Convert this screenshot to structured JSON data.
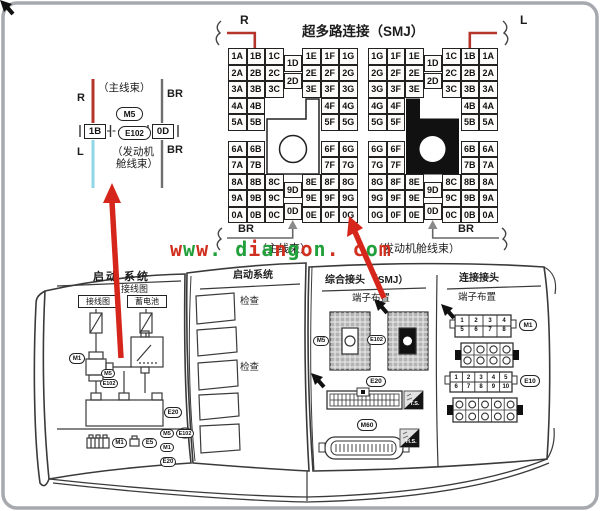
{
  "title": "超多路连接（SMJ）",
  "watermark": {
    "text": "www. diangon. com",
    "color_a": "#d03020",
    "color_b": "#22a03c"
  },
  "smj": {
    "r_label": "R",
    "l_label": "L",
    "br_left": "BR",
    "br_right": "BR",
    "main_harness_label": "（主线束）",
    "engine_harness_label": "（发动机舱线束）",
    "left_grid": {
      "rows": [
        [
          "1A",
          "1B",
          "1C",
          "1D",
          "1E",
          "1F",
          "1G"
        ],
        [
          "2A",
          "2B",
          "2C",
          "2D",
          "2E",
          "2F",
          "2G"
        ],
        [
          "3A",
          "3B",
          "3C",
          null,
          "3E",
          "3F",
          "3G"
        ],
        [
          "4A",
          "4B",
          null,
          null,
          null,
          "4F",
          "4G"
        ],
        [
          "5A",
          "5B",
          null,
          null,
          null,
          "5F",
          "5G"
        ],
        [
          "6A",
          "6B",
          null,
          null,
          null,
          "6F",
          "6G"
        ],
        [
          "7A",
          "7B",
          null,
          null,
          null,
          "7F",
          "7G"
        ],
        [
          "8A",
          "8B",
          "8C",
          "9D",
          "8E",
          "8F",
          "8G"
        ],
        [
          "9A",
          "9B",
          "9C",
          null,
          "9E",
          "9F",
          "9G"
        ],
        [
          "0A",
          "0B",
          "0C",
          "0D",
          "0E",
          "0F",
          "0G"
        ]
      ]
    },
    "right_grid": {
      "rows": [
        [
          "1G",
          "1F",
          "1E",
          "1D",
          "1C",
          "1B",
          "1A"
        ],
        [
          "2G",
          "2F",
          "2E",
          "2D",
          "2C",
          "2B",
          "2A"
        ],
        [
          "3G",
          "3F",
          "3E",
          null,
          "3C",
          "3B",
          "3A"
        ],
        [
          "4G",
          "4F",
          null,
          null,
          null,
          "4B",
          "4A"
        ],
        [
          "5G",
          "5F",
          null,
          null,
          null,
          "5B",
          "5A"
        ],
        [
          "6G",
          "6F",
          null,
          null,
          null,
          "6B",
          "6A"
        ],
        [
          "7G",
          "7F",
          null,
          null,
          null,
          "7B",
          "7A"
        ],
        [
          "8G",
          "8F",
          "8E",
          "9D",
          "8C",
          "8B",
          "8A"
        ],
        [
          "9G",
          "9F",
          "9E",
          null,
          "9C",
          "9B",
          "9A"
        ],
        [
          "0G",
          "0F",
          "0E",
          "0D",
          "0C",
          "0B",
          "0A"
        ]
      ]
    }
  },
  "junction": {
    "main_harness": "（主线束）",
    "r": "R",
    "l": "L",
    "br_top": "BR",
    "br_bottom": "BR",
    "connector_top": "M5",
    "connector_bottom": "E102",
    "pin_left": "1B",
    "pin_right": "0D",
    "engine_line1": "（发动机",
    "engine_line2": "舱线束）"
  },
  "book": {
    "left_page": {
      "header": "启动  系统",
      "subheader": "接线图",
      "wiring_box": "接线图",
      "battery_box": "蓄电池",
      "oval_m1": "M1",
      "oval_m5_small": "M5",
      "oval_e102_small": "E102",
      "oval_e20": "E20",
      "oval_m1_b": "M1",
      "oval_e5": "E5",
      "oval_m5_c": "M5",
      "oval_e102_c": "E102",
      "oval_m1_c": "M1",
      "oval_e20_c": "E20"
    },
    "middle_page": {
      "header": "启动系统",
      "check_1": "检查",
      "check_2": "检查"
    },
    "right_page": {
      "smj_header": "综合接头 （SMJ）",
      "terminal_label": "端子布置",
      "oval_m5": "M5",
      "oval_e102": "E102",
      "oval_e20": "E20",
      "oval_m60": "M60",
      "badge_ts": "T.S.",
      "badge_hs": "H.S.",
      "conn_header": "连接接头",
      "terminal_label_2": "端子布置",
      "oval_m1": "M1",
      "oval_e10": "E10",
      "m1_pins": [
        "1",
        "2",
        "3",
        "4",
        "5",
        "6",
        "7",
        "8"
      ],
      "e10_pins": [
        "1",
        "2",
        "3",
        "4",
        "5",
        "6",
        "7",
        "8",
        "9",
        "10"
      ]
    }
  }
}
